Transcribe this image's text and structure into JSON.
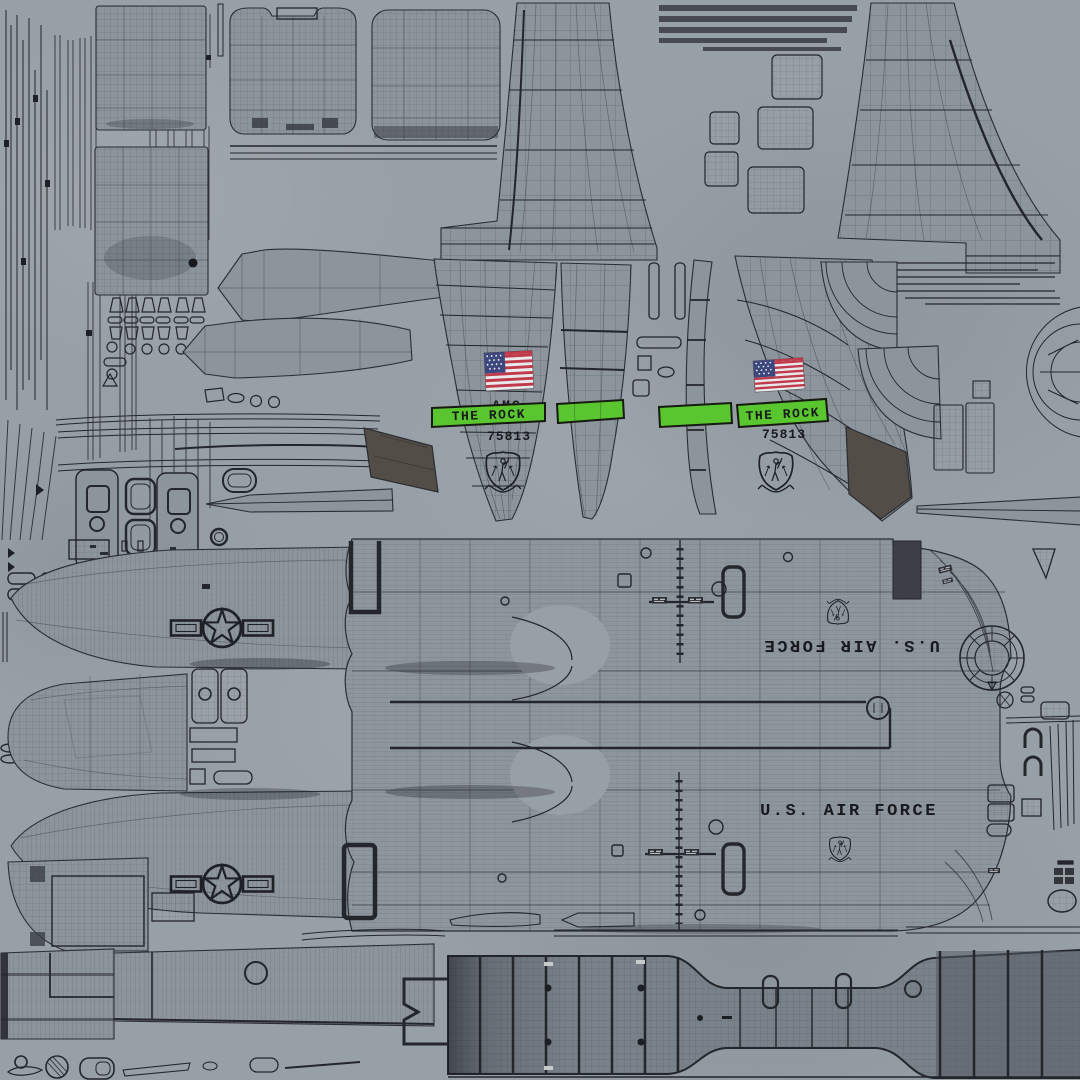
{
  "meta": {
    "type": "uv-texture-atlas",
    "subject": "Military transport aircraft wireframe texture sheet"
  },
  "colors": {
    "background": "#98a0a7",
    "wireframe": "#23262b",
    "panel_fill": "#8c949c",
    "dark_panel": "#3c4046",
    "antiglare_patch": "#524e47",
    "green_stripe": "#5ac62f",
    "flag_red": "#bf3a4a",
    "flag_blue": "#3c477e",
    "flag_white": "#e9e9ec",
    "decal_black": "#17191d"
  },
  "decals": {
    "tail_left": {
      "flag": "us-flag-icon",
      "command": "AMC",
      "nickname": "THE ROCK",
      "tail_number": "75813",
      "emblem": "command-shield-icon"
    },
    "tail_right": {
      "flag": "us-flag-icon",
      "command": "AMC",
      "nickname": "THE ROCK",
      "tail_number": "75813",
      "emblem": "command-shield-icon"
    },
    "fuselage_upper": {
      "text": "U.S. AIR FORCE",
      "orientation": "inverted",
      "emblem": "command-shield-icon"
    },
    "fuselage_lower": {
      "text": "U.S. AIR FORCE",
      "orientation": "upright",
      "emblem": "command-shield-icon"
    },
    "wing_upper": {
      "insignia": "star-and-bars-icon"
    },
    "wing_lower": {
      "insignia": "star-and-bars-icon"
    }
  }
}
